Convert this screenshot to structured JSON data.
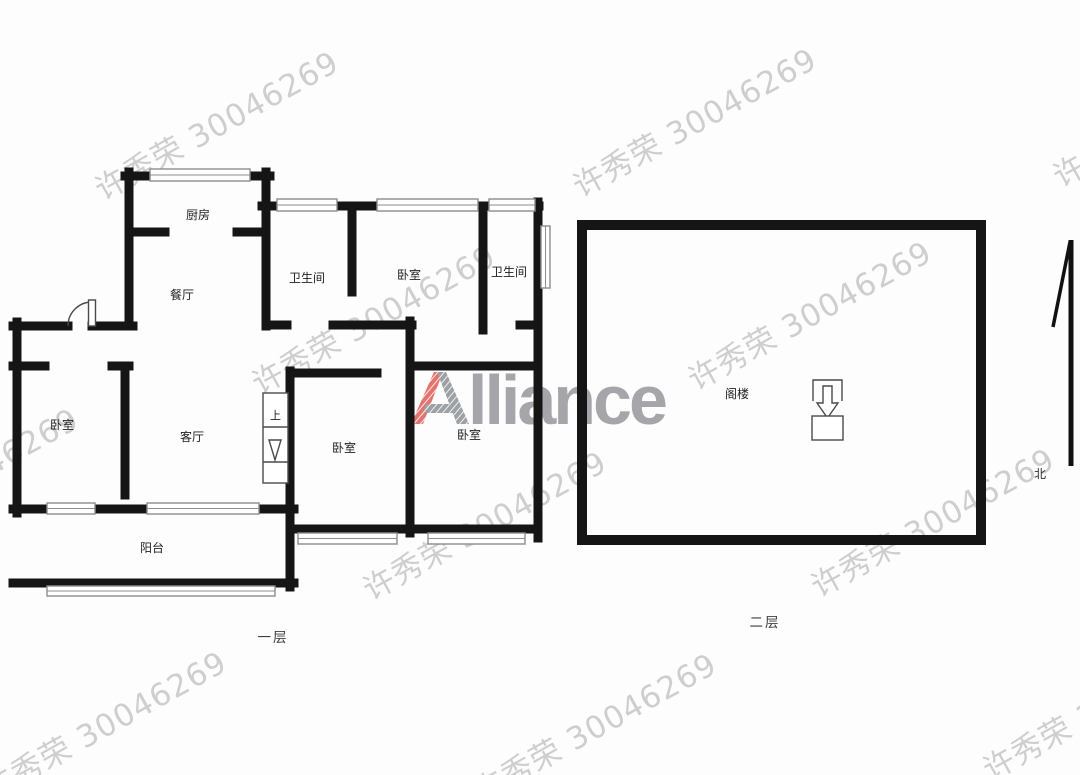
{
  "watermark": {
    "text": "许秀荣 30046269",
    "color": "#bdbdbd"
  },
  "logo": {
    "letter_a": "A",
    "rest": "lliance",
    "red": "#e2736d",
    "gray": "#a6a6aa"
  },
  "plan": {
    "wall_color": "#151515",
    "floor1": {
      "caption": "一层",
      "stair_label": "上",
      "rooms": [
        {
          "id": "kitchen",
          "label": "厨房"
        },
        {
          "id": "dining",
          "label": "餐厅"
        },
        {
          "id": "bathroom-1",
          "label": "卫生间"
        },
        {
          "id": "bedroom-top",
          "label": "卧室"
        },
        {
          "id": "bathroom-2",
          "label": "卫生间"
        },
        {
          "id": "bedroom-left",
          "label": "卧室"
        },
        {
          "id": "living-room",
          "label": "客厅"
        },
        {
          "id": "bedroom-middle",
          "label": "卧室"
        },
        {
          "id": "bedroom-right",
          "label": "卧室"
        },
        {
          "id": "balcony",
          "label": "阳台"
        }
      ]
    },
    "floor2": {
      "caption": "二层",
      "rooms": [
        {
          "id": "attic",
          "label": "阁楼"
        }
      ]
    },
    "north": {
      "label": "北"
    }
  }
}
